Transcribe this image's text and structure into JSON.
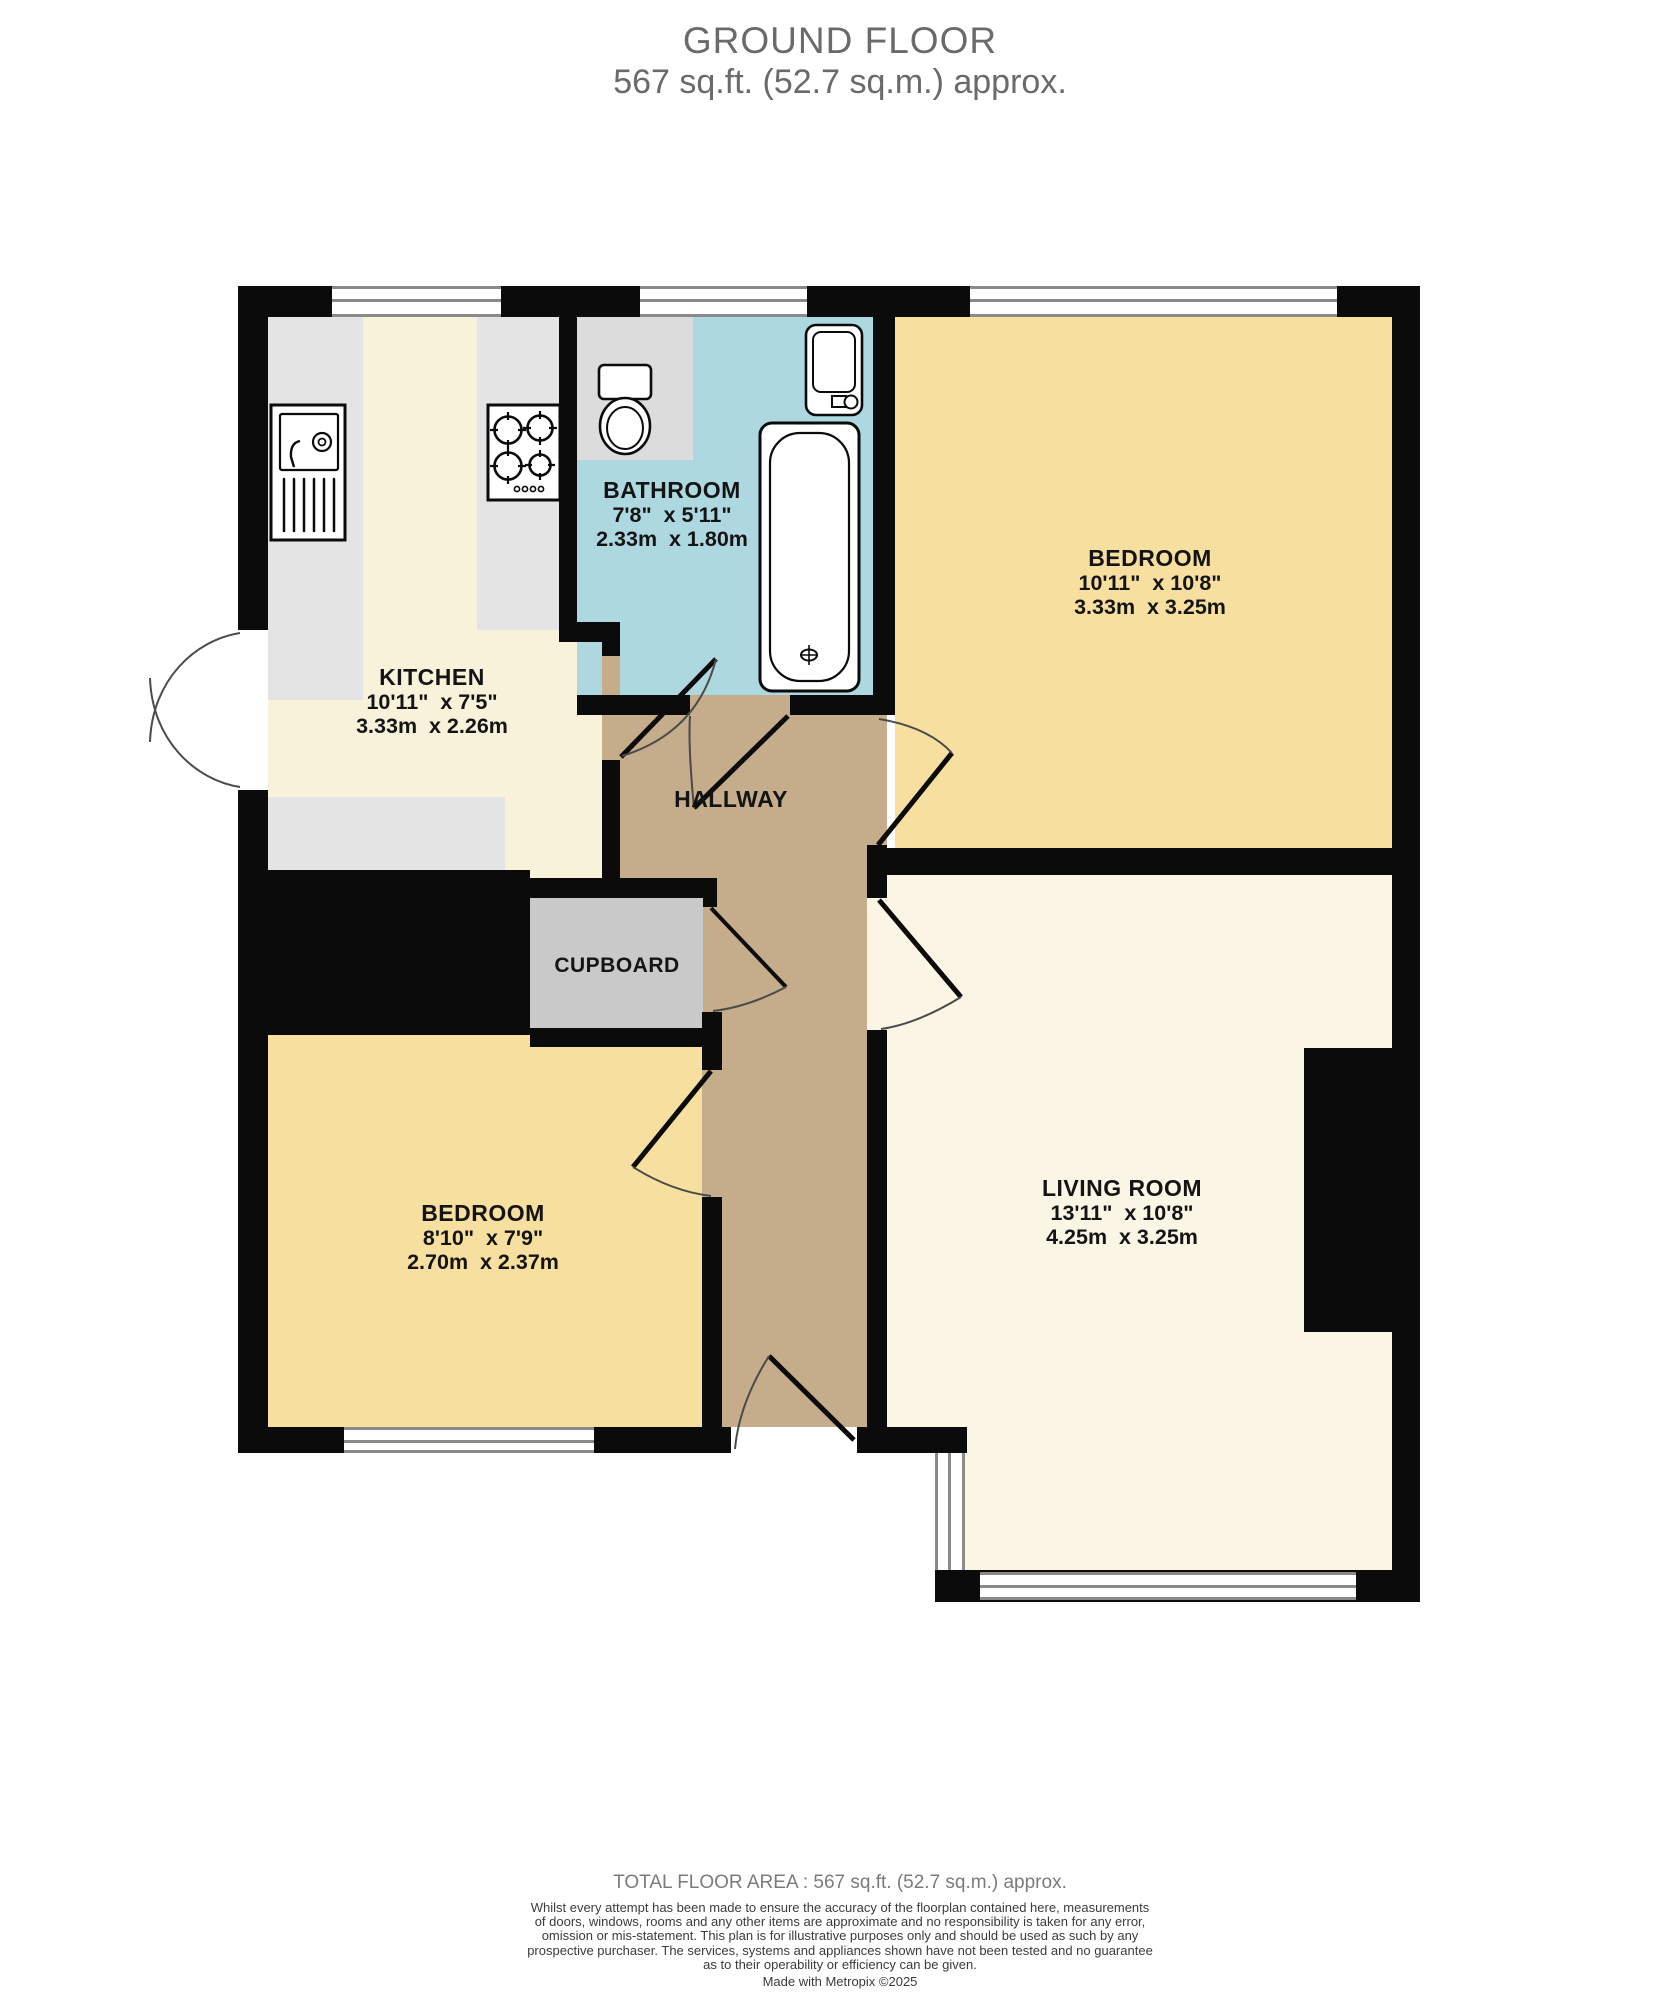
{
  "header": {
    "title": "GROUND FLOOR",
    "subtitle": "567 sq.ft. (52.7 sq.m.) approx."
  },
  "rooms": [
    {
      "id": "kitchen",
      "name": "KITCHEN",
      "dims_imperial": "10'11\"  x 7'5\"",
      "dims_metric": "3.33m  x 2.26m",
      "fixtures": [
        "sink",
        "hob"
      ],
      "floor_color": "#f9f2da"
    },
    {
      "id": "bathroom",
      "name": "BATHROOM",
      "dims_imperial": "7'8\"  x 5'11\"",
      "dims_metric": "2.33m  x 1.80m",
      "fixtures": [
        "toilet",
        "washbasin",
        "bathtub"
      ],
      "floor_color": "#aed8e0"
    },
    {
      "id": "bedroom-1",
      "name": "BEDROOM",
      "dims_imperial": "10'11\"  x 10'8\"",
      "dims_metric": "3.33m  x 3.25m",
      "fixtures": [],
      "floor_color": "#f6df9f"
    },
    {
      "id": "hallway",
      "name": "HALLWAY",
      "floor_color": "#c5ac8a"
    },
    {
      "id": "cupboard",
      "name": "CUPBOARD",
      "floor_color": "#c9c9c9"
    },
    {
      "id": "bedroom-2",
      "name": "BEDROOM",
      "dims_imperial": "8'10\"  x 7'9\"",
      "dims_metric": "2.70m  x 2.37m",
      "fixtures": [],
      "floor_color": "#f6df9f"
    },
    {
      "id": "living-room",
      "name": "LIVING ROOM",
      "dims_imperial": "13'11\"  x 10'8\"",
      "dims_metric": "4.25m  x 3.25m",
      "fixtures": [],
      "floor_color": "#faf5e4"
    }
  ],
  "footer": {
    "total_area": "TOTAL FLOOR AREA : 567 sq.ft. (52.7 sq.m.) approx.",
    "disclaimer": "Whilst every attempt has been made to ensure the accuracy of the floorplan contained here, measurements\nof doors, windows, rooms and any other items are approximate and no responsibility is taken for any error,\nomission or mis-statement. This plan is for illustrative purposes only and should be used as such by any\nprospective purchaser. The services, systems and appliances shown have not been tested and no guarantee\nas to their operability or efficiency can be given.",
    "credit": "Made with Metropix ©2025"
  },
  "colors": {
    "wall": "#0b0b0b",
    "window_frame": "#8a8a8a",
    "door_arc": "#4a4a4a"
  }
}
